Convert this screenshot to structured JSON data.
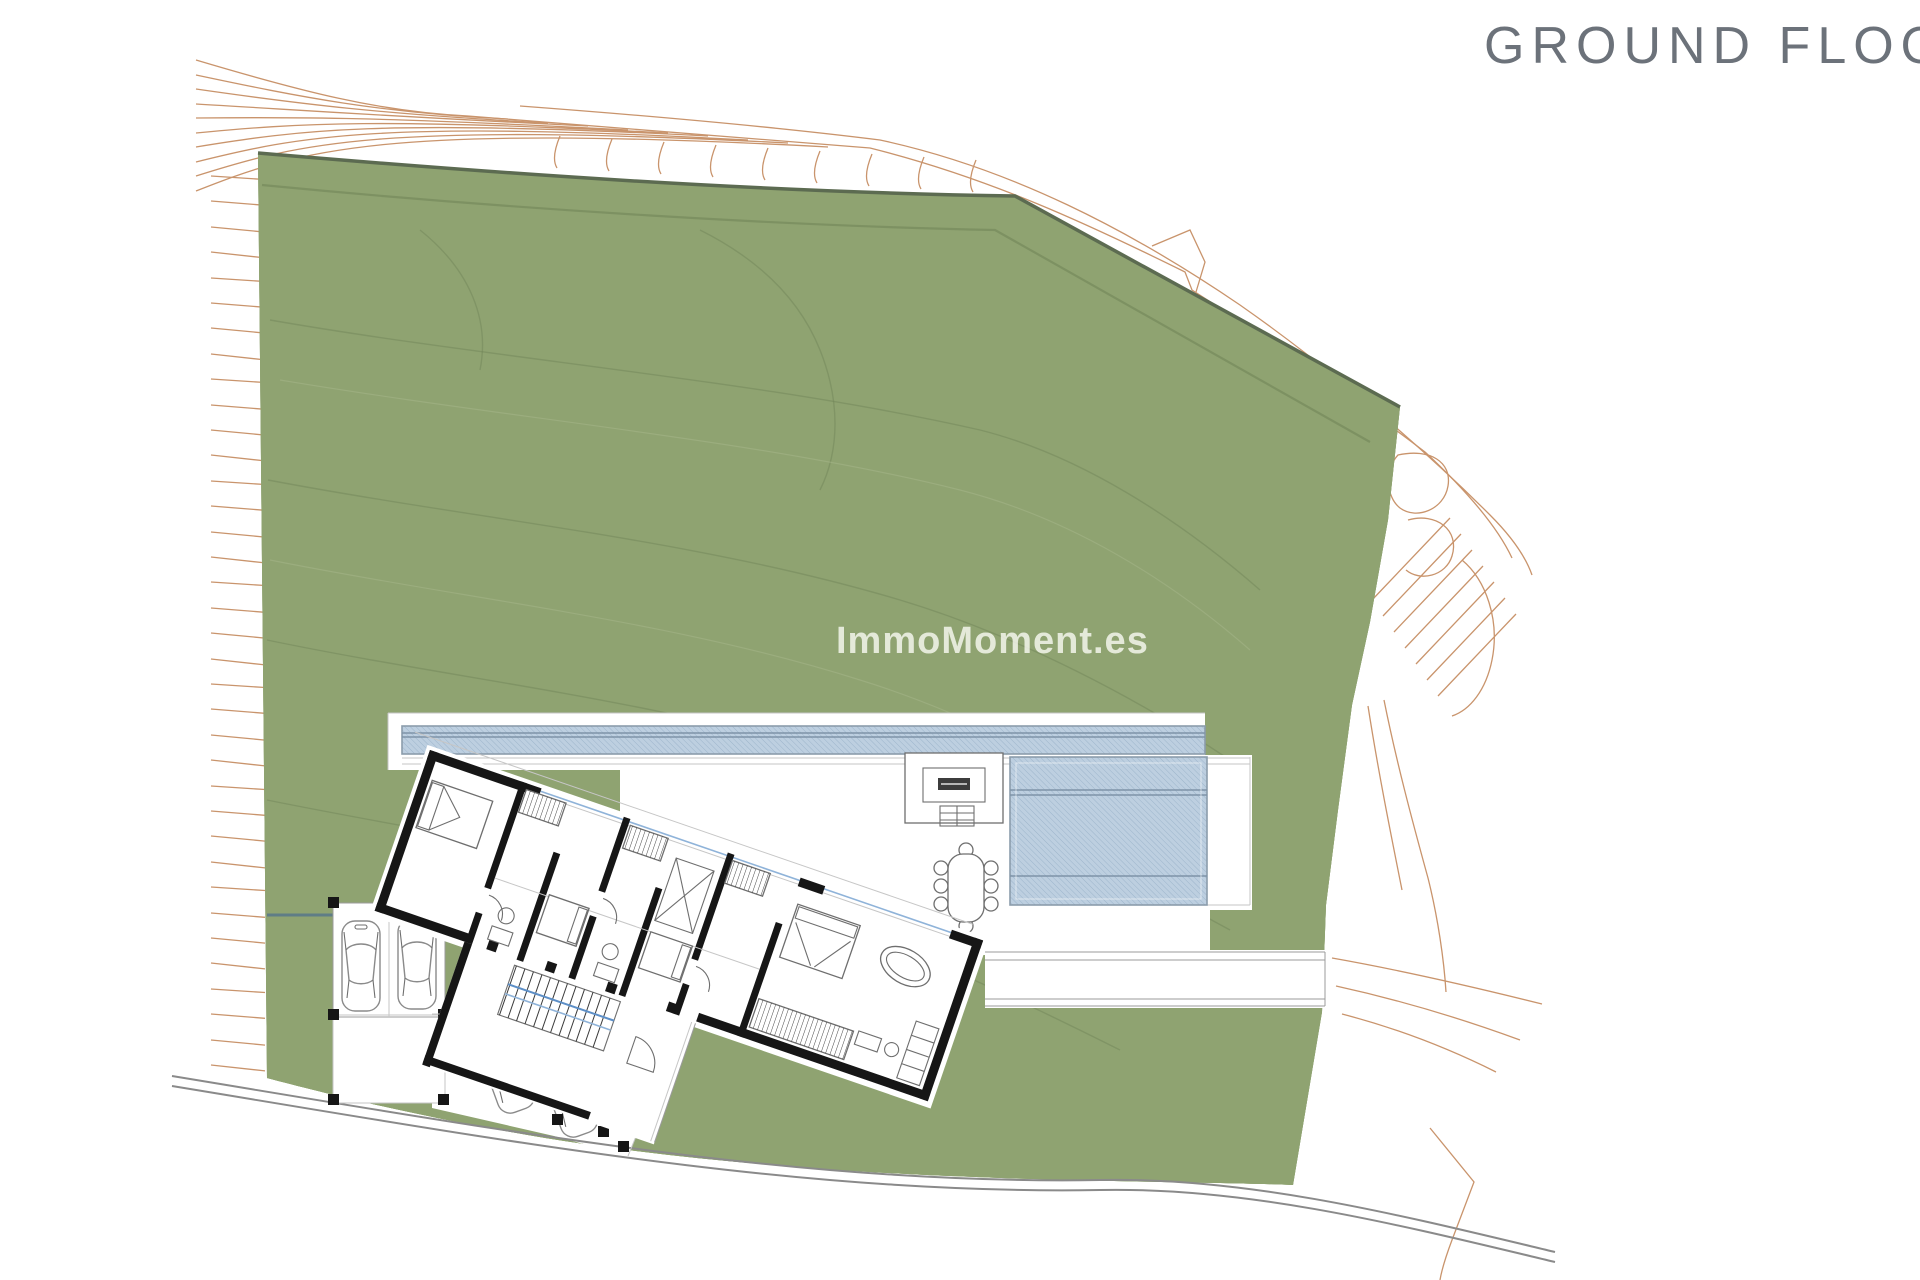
{
  "header": {
    "title": "GROUND FLOO"
  },
  "watermark": {
    "text": "ImmoMoment.es"
  },
  "colors": {
    "plot_green": "#8fa371",
    "plot_green_edge": "#5c6b51",
    "green_contour": "#6f8356",
    "contour_orange": "#c9946c",
    "pool_blue": "#bdcfe0",
    "pool_border": "#8b9cab",
    "accent_blue": "#5d8fc7",
    "wall_black": "#161616",
    "line_gray": "#9b9b9b",
    "road_gray": "#8a8a8a",
    "title_gray": "#6c727a",
    "watermark_white": "rgba(252,252,246,0.78)"
  }
}
